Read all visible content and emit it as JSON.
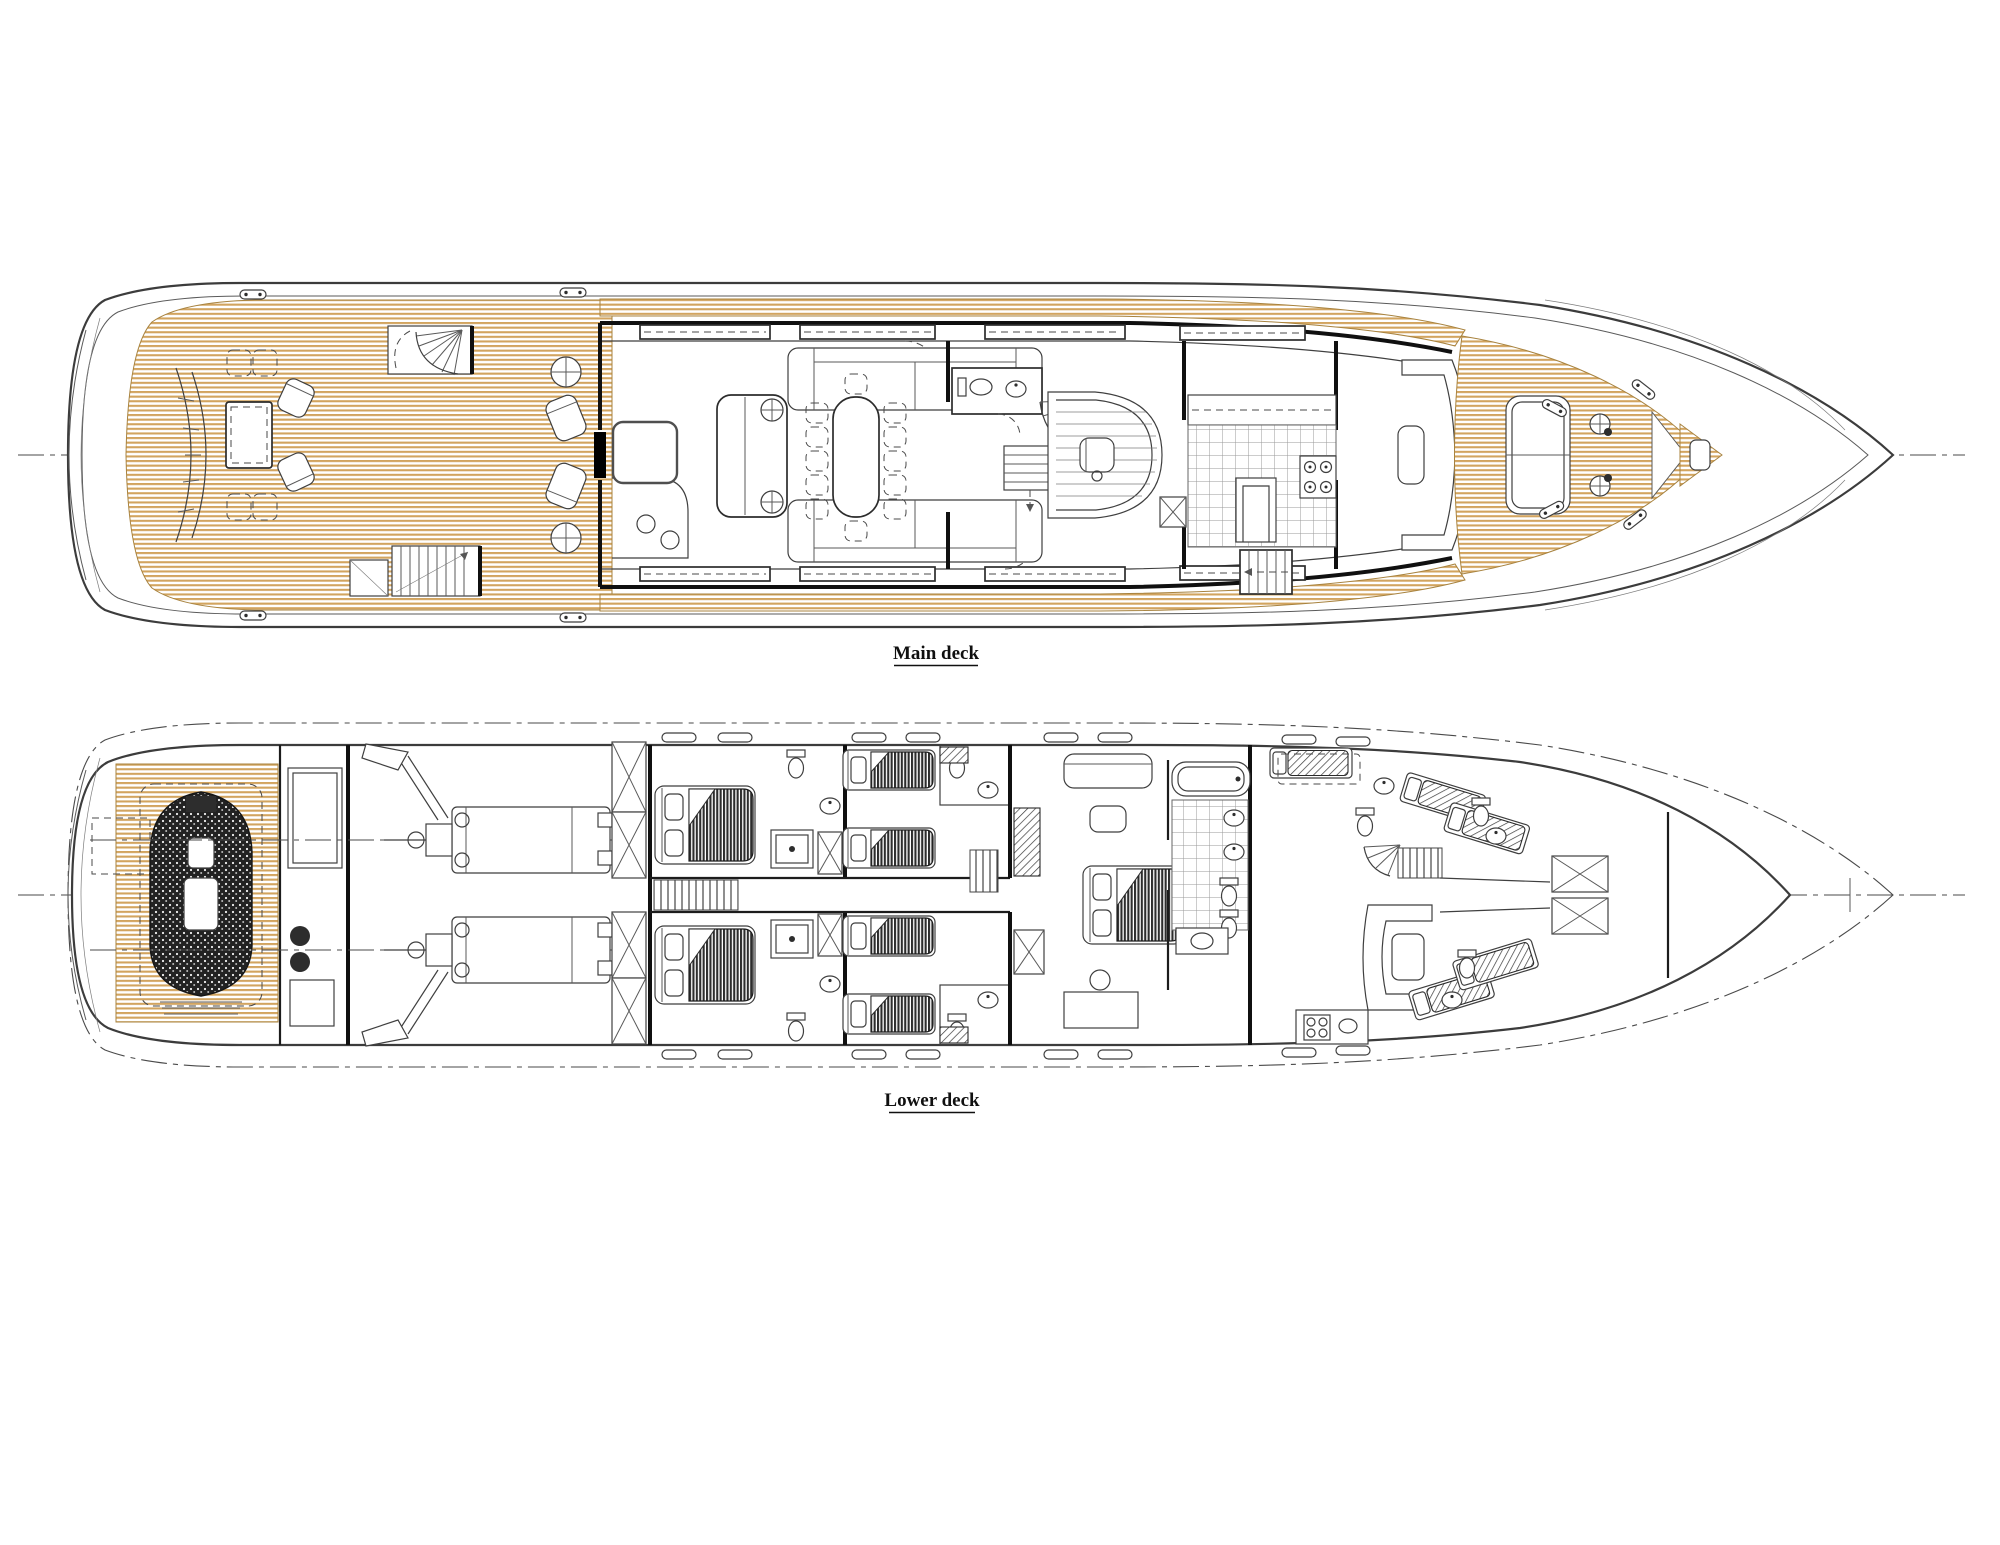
{
  "labels": {
    "main_deck": "Main deck",
    "lower_deck": "Lower deck"
  },
  "colors": {
    "paper": "#ffffff",
    "teak": "#d2a45f",
    "teak_dark": "#a8833f",
    "line": "#3c3c3c",
    "wall": "#101010",
    "dark_fill": "#2d2d2d",
    "tile_line": "#9a9a9a",
    "centerline": "#4a4a4a"
  }
}
